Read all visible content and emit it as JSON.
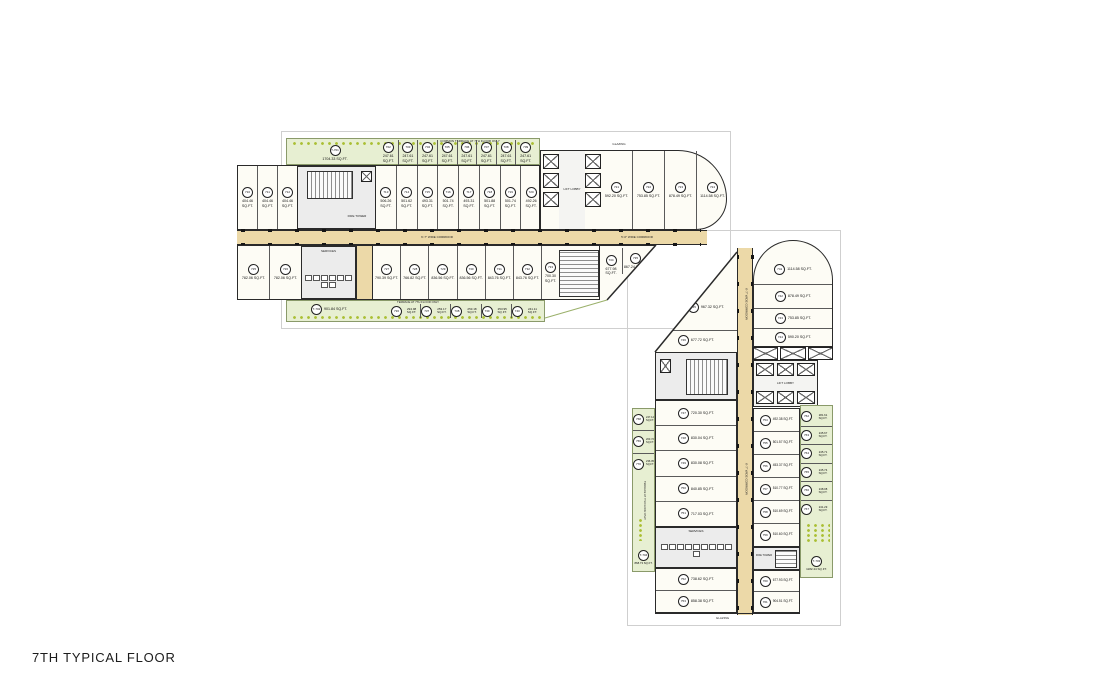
{
  "title": "7TH TYPICAL FLOOR",
  "notes": {
    "lift_lobby": "LIFT LOBBY",
    "fire_tower": "FIRE TOWER",
    "glazing": "GLAZING",
    "services": "SERVICES",
    "terrace_note": "TERRACE AT 7TH FLOOR ONLY",
    "common_terrace_note": "COMMON TERRACE AT 7TH FLOOR ONLY",
    "corridor_main": "6'-7\" WIDE CORRIDOR",
    "corridor_right": "5'-0\" WIDE CORRIDOR"
  },
  "colors": {
    "corridor": "#ecd9a8",
    "terrace_green": "#e7efd2",
    "plant_green": "#aabf34",
    "wall": "#2a2a2a",
    "core_gray": "#ececec",
    "room_cream": "#fdfcf5"
  },
  "wing_a": {
    "terrace_top": {
      "id": "T-701",
      "area": "1704.33 SQ.FT."
    },
    "balconies_top": [
      {
        "id": "702",
        "area": "247.61 SQ.FT."
      },
      {
        "id": "703",
        "area": "247.61 SQ.FT."
      },
      {
        "id": "704",
        "area": "247.61 SQ.FT."
      },
      {
        "id": "705",
        "area": "247.61 SQ.FT."
      },
      {
        "id": "706",
        "area": "247.61 SQ.FT."
      },
      {
        "id": "707",
        "area": "247.61 SQ.FT."
      },
      {
        "id": "708",
        "area": "247.61 SQ.FT."
      },
      {
        "id": "709",
        "area": "247.61 SQ.FT."
      }
    ],
    "upper_left": [
      {
        "id": "710",
        "area": "404.46 SQ.FT."
      },
      {
        "id": "711",
        "area": "404.46 SQ.FT."
      },
      {
        "id": "712",
        "area": "404.46 SQ.FT."
      }
    ],
    "upper_mid": [
      {
        "id": "713",
        "area": "506.26 SQ.FT."
      },
      {
        "id": "714",
        "area": "501.62 SQ.FT."
      },
      {
        "id": "715",
        "area": "493.31 SQ.FT."
      },
      {
        "id": "716",
        "area": "501.74 SQ.FT."
      },
      {
        "id": "717",
        "area": "493.31 SQ.FT."
      },
      {
        "id": "718",
        "area": "501.88 SQ.FT."
      },
      {
        "id": "719",
        "area": "501.74 SQ.FT."
      },
      {
        "id": "720",
        "area": "492.26 SQ.FT."
      }
    ],
    "upper_right": [
      {
        "id": "721",
        "area": "592.20 SQ.FT."
      },
      {
        "id": "722",
        "area": "753.85 SQ.FT."
      },
      {
        "id": "723",
        "area": "878.49 SQ.FT."
      },
      {
        "id": "724",
        "area": "1114.58 SQ.FT."
      }
    ],
    "lower_left": [
      {
        "id": "725",
        "area": "782.06 SQ.FT."
      },
      {
        "id": "726",
        "area": "782.06 SQ.FT."
      }
    ],
    "lower_mid": [
      {
        "id": "727",
        "area": "790.39 SQ.FT."
      },
      {
        "id": "728",
        "area": "766.82 SQ.FT."
      },
      {
        "id": "729",
        "area": "836.56 SQ.FT."
      },
      {
        "id": "730",
        "area": "836.56 SQ.FT."
      },
      {
        "id": "731",
        "area": "843.76 SQ.FT."
      },
      {
        "id": "732",
        "area": "843.76 SQ.FT."
      }
    ],
    "lower_right": [
      {
        "id": "733",
        "area": "700.30 SQ.FT."
      },
      {
        "id": "734",
        "area": "677.98 SQ.FT."
      },
      {
        "id": "735",
        "area": "867.24 SQ.FT."
      }
    ],
    "terrace_bottom": {
      "id": "T-702",
      "area": "901.84 SQ.FT."
    },
    "balconies_bottom": [
      {
        "id": "736",
        "area": "294.98 SQ.FT."
      },
      {
        "id": "737",
        "area": "253.17 SQ.FT."
      },
      {
        "id": "738",
        "area": "253.18 SQ.FT."
      },
      {
        "id": "739",
        "area": "253.95 SQ.FT."
      },
      {
        "id": "740",
        "area": "241.11 SQ.FT."
      }
    ]
  },
  "wing_b": {
    "top_units": [
      {
        "id": "741",
        "area": "1114.58 SQ.FT."
      },
      {
        "id": "742",
        "area": "878.49 SQ.FT."
      },
      {
        "id": "743",
        "area": "753.85 SQ.FT."
      },
      {
        "id": "744",
        "area": "590.20 SQ.FT."
      }
    ],
    "left_units_upper": [
      {
        "id": "745",
        "area": "967.32 SQ.FT."
      },
      {
        "id": "746",
        "area": "677.72 SQ.FT."
      }
    ],
    "left_units_mid": [
      {
        "id": "747",
        "area": "720.30 SQ.FT."
      },
      {
        "id": "748",
        "area": "830.04 SQ.FT."
      },
      {
        "id": "749",
        "area": "830.08 SQ.FT."
      },
      {
        "id": "750",
        "area": "840.85 SQ.FT."
      },
      {
        "id": "751",
        "area": "717.03 SQ.FT."
      }
    ],
    "left_units_lower": [
      {
        "id": "752",
        "area": "738.62 SQ.FT."
      },
      {
        "id": "753",
        "area": "858.38 SQ.FT."
      }
    ],
    "right_units": [
      {
        "id": "754",
        "area": "492.38 SQ.FT."
      },
      {
        "id": "755",
        "area": "501.57 SQ.FT."
      },
      {
        "id": "756",
        "area": "453.37 SQ.FT."
      },
      {
        "id": "757",
        "area": "510.77 SQ.FT."
      },
      {
        "id": "758",
        "area": "510.69 SQ.FT."
      },
      {
        "id": "759",
        "area": "510.60 SQ.FT."
      }
    ],
    "right_units_lower": [
      {
        "id": "760",
        "area": "677.93 SQ.FT."
      },
      {
        "id": "761",
        "area": "904.51 SQ.FT."
      }
    ],
    "terrace_right": [
      {
        "id": "762",
        "area": "281.61 SQ.FT."
      },
      {
        "id": "763",
        "area": "245.67 SQ.FT."
      },
      {
        "id": "764",
        "area": "245.71 SQ.FT."
      },
      {
        "id": "765",
        "area": "245.74 SQ.FT."
      },
      {
        "id": "766",
        "area": "248.08 SQ.FT."
      },
      {
        "id": "767",
        "area": "241.29 SQ.FT."
      }
    ],
    "terrace_right_big": {
      "id": "T-703",
      "area": "1182.44 SQ.FT."
    },
    "terrace_left": [
      {
        "id": "768",
        "area": "247.14 SQ.FT."
      },
      {
        "id": "769",
        "area": "203.72 SQ.FT."
      },
      {
        "id": "770",
        "area": "236.05 SQ.FT."
      }
    ],
    "terrace_left_big": {
      "id": "T-704",
      "area": "868.73 SQ.FT."
    }
  }
}
